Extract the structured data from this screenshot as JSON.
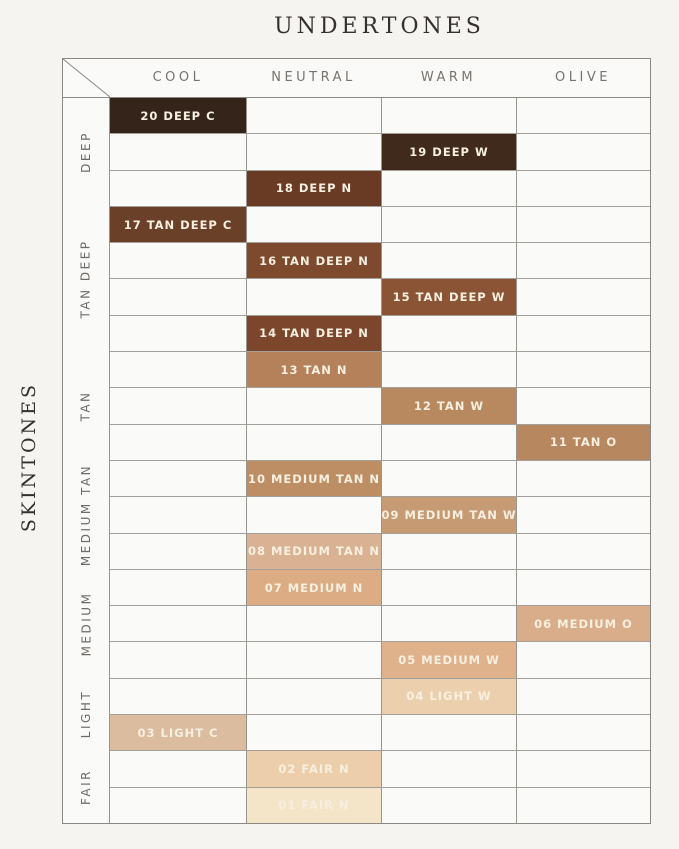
{
  "chart_data": {
    "type": "heatmap",
    "title": "UNDERTONES",
    "ylabel": "SKINTONES",
    "columns": [
      "COOL",
      "NEUTRAL",
      "WARM",
      "OLIVE"
    ],
    "groups": [
      {
        "label": "DEEP",
        "rows": 3
      },
      {
        "label": "TAN DEEP",
        "rows": 4
      },
      {
        "label": "TAN",
        "rows": 3
      },
      {
        "label": "MEDIUM TAN",
        "rows": 3
      },
      {
        "label": "MEDIUM",
        "rows": 3
      },
      {
        "label": "LIGHT",
        "rows": 2
      },
      {
        "label": "FAIR",
        "rows": 2
      }
    ],
    "shades": [
      {
        "label": "20 DEEP C",
        "group": "DEEP",
        "undertone": "COOL",
        "color": "#35241a"
      },
      {
        "label": "19 DEEP W",
        "group": "DEEP",
        "undertone": "WARM",
        "color": "#3f2a1b"
      },
      {
        "label": "18 DEEP N",
        "group": "DEEP",
        "undertone": "NEUTRAL",
        "color": "#693a24"
      },
      {
        "label": "17 TAN DEEP C",
        "group": "TAN DEEP",
        "undertone": "COOL",
        "color": "#6b4029"
      },
      {
        "label": "16 TAN DEEP N",
        "group": "TAN DEEP",
        "undertone": "NEUTRAL",
        "color": "#7e4a2e"
      },
      {
        "label": "15 TAN DEEP W",
        "group": "TAN DEEP",
        "undertone": "WARM",
        "color": "#8b5434"
      },
      {
        "label": "14 TAN DEEP N",
        "group": "TAN DEEP",
        "undertone": "NEUTRAL",
        "color": "#7b462c"
      },
      {
        "label": "13 TAN N",
        "group": "TAN",
        "undertone": "NEUTRAL",
        "color": "#b5815b"
      },
      {
        "label": "12 TAN W",
        "group": "TAN",
        "undertone": "WARM",
        "color": "#b8895f"
      },
      {
        "label": "11 TAN O",
        "group": "TAN",
        "undertone": "OLIVE",
        "color": "#b78860"
      },
      {
        "label": "10 MEDIUM TAN N",
        "group": "MEDIUM TAN",
        "undertone": "NEUTRAL",
        "color": "#bd8d63"
      },
      {
        "label": "09 MEDIUM TAN W",
        "group": "MEDIUM TAN",
        "undertone": "WARM",
        "color": "#c69a73"
      },
      {
        "label": "08 MEDIUM TAN N",
        "group": "MEDIUM TAN",
        "undertone": "NEUTRAL",
        "color": "#d9b294"
      },
      {
        "label": "07 MEDIUM N",
        "group": "MEDIUM",
        "undertone": "NEUTRAL",
        "color": "#dcac84"
      },
      {
        "label": "06 MEDIUM O",
        "group": "MEDIUM",
        "undertone": "OLIVE",
        "color": "#d9ad89"
      },
      {
        "label": "05 MEDIUM W",
        "group": "MEDIUM",
        "undertone": "WARM",
        "color": "#dfb28b"
      },
      {
        "label": "04 LIGHT W",
        "group": "LIGHT",
        "undertone": "WARM",
        "color": "#ecd0ae"
      },
      {
        "label": "03 LIGHT C",
        "group": "LIGHT",
        "undertone": "COOL",
        "color": "#dcbc9e"
      },
      {
        "label": "02 FAIR N",
        "group": "FAIR",
        "undertone": "NEUTRAL",
        "color": "#eccfaa"
      },
      {
        "label": "01 FAIR N",
        "group": "FAIR",
        "undertone": "NEUTRAL",
        "color": "#f4e4c8"
      }
    ]
  },
  "theme": {
    "page_background": "#f5f4f1",
    "grid_background": "#fafaf8",
    "outer_border": "#8c8984",
    "grid_line": "#a3a09b",
    "title_text": "#35302b",
    "column_header_text": "#78746f",
    "group_label_text": "#6f6b66",
    "swatch_text": "#f7efe0"
  }
}
